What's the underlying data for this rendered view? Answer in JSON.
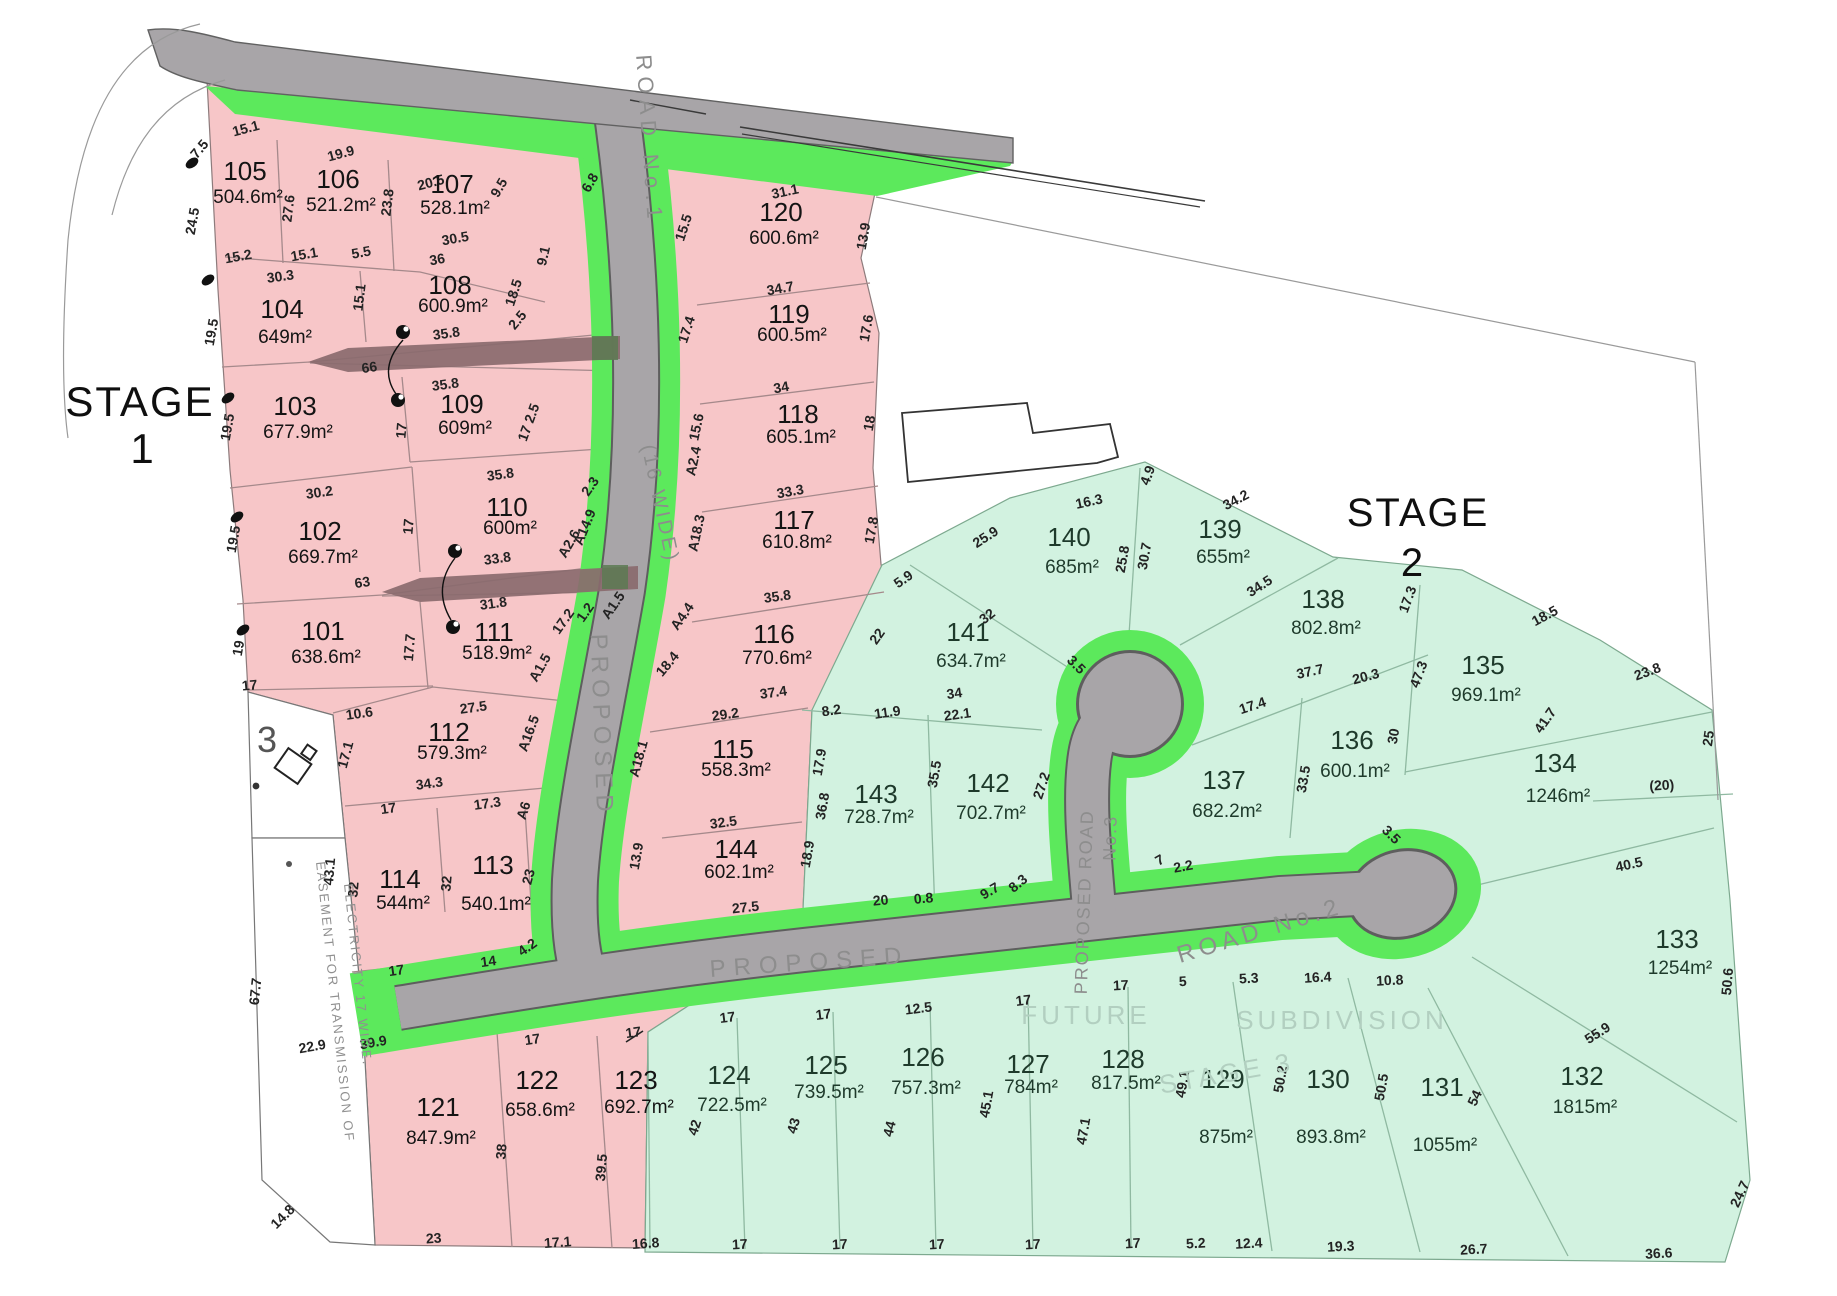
{
  "stage_labels": {
    "stage1_word": "STAGE",
    "stage1_num": "1",
    "stage2_word": "STAGE",
    "stage2_num": "2"
  },
  "road_labels": {
    "road1_name": "ROAD No.1",
    "road1_width": "(16 WIDE)",
    "road1_proposed": "PROPOSED",
    "road2_proposed": "PROPOSED",
    "road2_name": "ROAD No.2",
    "road3_line1": "PROPOSED ROAD",
    "road3_line2": "No.3"
  },
  "watermarks": {
    "future": "FUTURE",
    "subdivision": "SUBDIVISION",
    "stage3": "STAGE 3"
  },
  "easement": {
    "line1": "EASEMENT FOR TRANSMISSION OF",
    "line2": "ELECTRICITY 17 WIDE."
  },
  "existing_parcel": {
    "number": "3"
  },
  "colors": {
    "stage1_fill": "#f7c6c8",
    "stage2_fill": "#d2f2e0",
    "road_fill": "#a8a5a8",
    "road_casing": "#5e5e5e",
    "verge_green": "#5ce95c",
    "easement_arrow": "#8a6a6e",
    "arrow_overlap": "#5c7a52",
    "stage1_text": "#141414",
    "stage2_text": "#1e3a2b"
  },
  "lots": [
    [
      "101",
      "638.6m²",
      323,
      640,
      1,
      23
    ],
    [
      "102",
      "669.7m²",
      320,
      540,
      1,
      23
    ],
    [
      "103",
      "677.9m²",
      295,
      415,
      1,
      23
    ],
    [
      "104",
      "649m²",
      282,
      318,
      1,
      25
    ],
    [
      "105",
      "504.6m²",
      245,
      180,
      1,
      23
    ],
    [
      "106",
      "521.2m²",
      338,
      188,
      1,
      23
    ],
    [
      "107",
      "528.1m²",
      452,
      193,
      1,
      21
    ],
    [
      "108",
      "600.9m²",
      450,
      294,
      1,
      18
    ],
    [
      "109",
      "609m²",
      462,
      413,
      1,
      21
    ],
    [
      "110",
      "600m²",
      507,
      516,
      1,
      18
    ],
    [
      "111",
      "518.9m²",
      494,
      641,
      1,
      18
    ],
    [
      "112",
      "579.3m²",
      449,
      741,
      1,
      18
    ],
    [
      "113",
      "540.1m²",
      493,
      874,
      1,
      36
    ],
    [
      "114",
      "544m²",
      400,
      888,
      1,
      21
    ],
    [
      "115",
      "558.3m²",
      733,
      758,
      1,
      18
    ],
    [
      "116",
      "770.6m²",
      774,
      643,
      1,
      21
    ],
    [
      "117",
      "610.8m²",
      794,
      529,
      1,
      19
    ],
    [
      "118",
      "605.1m²",
      798,
      423,
      1,
      20
    ],
    [
      "119",
      "600.5m²",
      789,
      323,
      1,
      18
    ],
    [
      "120",
      "600.6m²",
      781,
      221,
      1,
      23
    ],
    [
      "121",
      "847.9m²",
      438,
      1116,
      1,
      28
    ],
    [
      "122",
      "658.6m²",
      537,
      1089,
      1,
      27
    ],
    [
      "123",
      "692.7m²",
      636,
      1089,
      1,
      24
    ],
    [
      "124",
      "722.5m²",
      729,
      1084,
      2,
      27
    ],
    [
      "125",
      "739.5m²",
      826,
      1074,
      2,
      24
    ],
    [
      "126",
      "757.3m²",
      923,
      1066,
      2,
      28
    ],
    [
      "127",
      "784m²",
      1028,
      1073,
      2,
      20
    ],
    [
      "128",
      "817.5m²",
      1123,
      1068,
      2,
      21
    ],
    [
      "129",
      "875m²",
      1223,
      1088,
      2,
      55
    ],
    [
      "130",
      "893.8m²",
      1328,
      1088,
      2,
      55
    ],
    [
      "131",
      "1055m²",
      1442,
      1096,
      2,
      55
    ],
    [
      "132",
      "1815m²",
      1582,
      1085,
      2,
      28
    ],
    [
      "133",
      "1254m²",
      1677,
      948,
      2,
      26
    ],
    [
      "134",
      "1246m²",
      1555,
      772,
      2,
      30
    ],
    [
      "135",
      "969.1m²",
      1483,
      674,
      2,
      27
    ],
    [
      "136",
      "600.1m²",
      1352,
      749,
      2,
      28
    ],
    [
      "137",
      "682.2m²",
      1224,
      789,
      2,
      28
    ],
    [
      "138",
      "802.8m²",
      1323,
      608,
      2,
      26
    ],
    [
      "139",
      "655m²",
      1220,
      538,
      2,
      25
    ],
    [
      "140",
      "685m²",
      1069,
      546,
      2,
      27
    ],
    [
      "141",
      "634.7m²",
      968,
      641,
      2,
      26
    ],
    [
      "142",
      "702.7m²",
      988,
      792,
      2,
      27
    ],
    [
      "143",
      "728.7m²",
      876,
      803,
      2,
      20
    ],
    [
      "144",
      "602.1m²",
      736,
      858,
      1,
      20
    ]
  ],
  "dims": [
    [
      "7.5",
      203,
      152,
      -50
    ],
    [
      "15.1",
      247,
      133,
      -15
    ],
    [
      "19.9",
      342,
      158,
      -15
    ],
    [
      "20.5",
      432,
      187,
      -15
    ],
    [
      "9.5",
      503,
      190,
      -60
    ],
    [
      "24.5",
      197,
      222,
      -80
    ],
    [
      "27.6",
      293,
      209,
      -83
    ],
    [
      "23.8",
      392,
      203,
      -83
    ],
    [
      "9.1",
      548,
      257,
      -77
    ],
    [
      "6.8",
      594,
      185,
      -60
    ],
    [
      "15.5",
      688,
      229,
      -72
    ],
    [
      "31.1",
      786,
      196,
      -12
    ],
    [
      "13.9",
      868,
      237,
      -80
    ],
    [
      "15.2",
      239,
      261,
      -10
    ],
    [
      "15.1",
      305,
      259,
      -10
    ],
    [
      "5.5",
      362,
      257,
      -10
    ],
    [
      "36",
      438,
      264,
      -10
    ],
    [
      "30.5",
      456,
      243,
      -10
    ],
    [
      "18.5",
      518,
      294,
      -72
    ],
    [
      "30.3",
      281,
      281,
      -8
    ],
    [
      "15.1",
      364,
      298,
      -83
    ],
    [
      "19.5",
      216,
      333,
      -80
    ],
    [
      "2.5",
      521,
      323,
      -50
    ],
    [
      "35.8",
      447,
      338,
      -8
    ],
    [
      "66",
      370,
      372,
      -8
    ],
    [
      "35.8",
      446,
      389,
      -8
    ],
    [
      "17.4",
      691,
      331,
      -72
    ],
    [
      "34.7",
      781,
      293,
      -10
    ],
    [
      "17.6",
      871,
      329,
      -80
    ],
    [
      "34",
      782,
      392,
      -10
    ],
    [
      "18",
      874,
      424,
      -80
    ],
    [
      "17 2.5",
      533,
      424,
      -70
    ],
    [
      "19.5",
      232,
      428,
      -80
    ],
    [
      "17",
      406,
      431,
      -85
    ],
    [
      "35.8",
      501,
      479,
      -8
    ],
    [
      "30.2",
      320,
      497,
      -8
    ],
    [
      "17",
      413,
      527,
      -85
    ],
    [
      "33.8",
      498,
      563,
      -8
    ],
    [
      "2.3",
      594,
      489,
      -55
    ],
    [
      "A14.9",
      589,
      529,
      -68
    ],
    [
      "A2.6",
      573,
      546,
      -60
    ],
    [
      "63",
      363,
      587,
      -8
    ],
    [
      "19.5",
      238,
      540,
      -80
    ],
    [
      "31.8",
      494,
      608,
      -8
    ],
    [
      "17.2",
      567,
      624,
      -55
    ],
    [
      "1.2",
      589,
      615,
      -55
    ],
    [
      "A1.5",
      617,
      608,
      -55
    ],
    [
      "A1.5",
      544,
      670,
      -60
    ],
    [
      "19",
      243,
      649,
      -80
    ],
    [
      "17.7",
      414,
      648,
      -85
    ],
    [
      "15.6",
      701,
      428,
      -78
    ],
    [
      "A2.4",
      698,
      462,
      -78
    ],
    [
      "33.3",
      791,
      496,
      -10
    ],
    [
      "17.8",
      876,
      531,
      -80
    ],
    [
      "A18.3",
      701,
      534,
      -78
    ],
    [
      "35.8",
      778,
      601,
      -8
    ],
    [
      "A4.4",
      686,
      619,
      -55
    ],
    [
      "18.4",
      671,
      667,
      -50
    ],
    [
      "5.9",
      906,
      583,
      -35
    ],
    [
      "22",
      881,
      639,
      -55
    ],
    [
      "37.4",
      774,
      697,
      -8
    ],
    [
      "29.2",
      726,
      719,
      -8
    ],
    [
      "A18.1",
      643,
      760,
      -75
    ],
    [
      "17",
      250,
      690,
      -5
    ],
    [
      "10.6",
      360,
      718,
      -8
    ],
    [
      "17.1",
      350,
      756,
      -75
    ],
    [
      "27.5",
      474,
      712,
      -8
    ],
    [
      "A16.5",
      533,
      735,
      -70
    ],
    [
      "34.3",
      430,
      788,
      -8
    ],
    [
      "17",
      389,
      813,
      -8
    ],
    [
      "17.3",
      488,
      808,
      -8
    ],
    [
      "A6",
      528,
      812,
      -72
    ],
    [
      "32",
      358,
      890,
      -85
    ],
    [
      "32",
      451,
      884,
      -85
    ],
    [
      "23",
      533,
      878,
      -75
    ],
    [
      "43.1",
      334,
      872,
      -85
    ],
    [
      "13.9",
      641,
      857,
      -80
    ],
    [
      "32.5",
      724,
      827,
      -8
    ],
    [
      "18.9",
      812,
      855,
      -80
    ],
    [
      "27.5",
      746,
      912,
      -6
    ],
    [
      "36.8",
      827,
      807,
      -80
    ],
    [
      "17.9",
      824,
      763,
      -80
    ],
    [
      "35.5",
      939,
      775,
      -80
    ],
    [
      "27.2",
      1046,
      787,
      -72
    ],
    [
      "20",
      881,
      905,
      -5
    ],
    [
      "0.8",
      924,
      903,
      -5
    ],
    [
      "9.7",
      992,
      895,
      -30
    ],
    [
      "8.3",
      1021,
      887,
      -40
    ],
    [
      "7",
      1162,
      864,
      -30
    ],
    [
      "2.2",
      1184,
      871,
      -10
    ],
    [
      "4.2",
      530,
      951,
      -35
    ],
    [
      "14",
      489,
      966,
      -8
    ],
    [
      "17",
      397,
      975,
      -8
    ],
    [
      "22.9",
      313,
      1051,
      -10
    ],
    [
      "39.9",
      374,
      1047,
      -10
    ],
    [
      "17",
      533,
      1044,
      -8
    ],
    [
      "17",
      634,
      1037,
      -8
    ],
    [
      "67.7",
      260,
      992,
      -84
    ],
    [
      "14.8",
      286,
      1220,
      -45
    ],
    [
      "38",
      506,
      1152,
      -85
    ],
    [
      "39.5",
      606,
      1168,
      -85
    ],
    [
      "23",
      434,
      1243,
      -4
    ],
    [
      "17.1",
      558,
      1247,
      -4
    ],
    [
      "16.8",
      646,
      1248,
      -4
    ],
    [
      "42",
      699,
      1129,
      -72
    ],
    [
      "43",
      798,
      1127,
      -74
    ],
    [
      "44",
      894,
      1130,
      -76
    ],
    [
      "45.1",
      991,
      1105,
      -80
    ],
    [
      "47.1",
      1088,
      1132,
      -80
    ],
    [
      "17",
      728,
      1022,
      -7
    ],
    [
      "17",
      824,
      1019,
      -7
    ],
    [
      "12.5",
      919,
      1013,
      -7
    ],
    [
      "17",
      1024,
      1005,
      -7
    ],
    [
      "17",
      740,
      1249,
      -3
    ],
    [
      "17",
      840,
      1249,
      -3
    ],
    [
      "17",
      937,
      1249,
      -3
    ],
    [
      "17",
      1033,
      1249,
      -3
    ],
    [
      "17",
      1133,
      1248,
      -3
    ],
    [
      "16.3",
      1090,
      506,
      -12
    ],
    [
      "25.9",
      988,
      541,
      -33
    ],
    [
      "4.9",
      1152,
      477,
      -70
    ],
    [
      "34.2",
      1238,
      504,
      -28
    ],
    [
      "25.8",
      1127,
      560,
      -80
    ],
    [
      "30.7",
      1149,
      557,
      -80
    ],
    [
      "34.5",
      1262,
      590,
      -33
    ],
    [
      "32",
      990,
      620,
      -38
    ],
    [
      "34",
      955,
      698,
      -8
    ],
    [
      "22.1",
      958,
      719,
      -8
    ],
    [
      "11.9",
      888,
      717,
      -8
    ],
    [
      "8.2",
      832,
      715,
      -8
    ],
    [
      "37.7",
      1311,
      676,
      -12
    ],
    [
      "20.3",
      1367,
      681,
      -15
    ],
    [
      "17.4",
      1254,
      710,
      -18
    ],
    [
      "33.5",
      1308,
      780,
      -80
    ],
    [
      "30",
      1398,
      737,
      -80
    ],
    [
      "47.3",
      1423,
      676,
      -70
    ],
    [
      "17.3",
      1412,
      601,
      -70
    ],
    [
      "18.5",
      1547,
      620,
      -28
    ],
    [
      "23.8",
      1649,
      676,
      -20
    ],
    [
      "25",
      1713,
      739,
      -82
    ],
    [
      "41.7",
      1549,
      723,
      -55
    ],
    [
      "(20)",
      1662,
      790,
      -3
    ],
    [
      "40.5",
      1630,
      869,
      -12
    ],
    [
      "50.6",
      1732,
      982,
      -85
    ],
    [
      "55.9",
      1600,
      1037,
      -33
    ],
    [
      "54",
      1479,
      1100,
      -65
    ],
    [
      "50.5",
      1386,
      1088,
      -80
    ],
    [
      "10.8",
      1390,
      985,
      -3
    ],
    [
      "16.4",
      1318,
      982,
      -3
    ],
    [
      "5.3",
      1249,
      983,
      -3
    ],
    [
      "5",
      1183,
      986,
      -3
    ],
    [
      "17",
      1121,
      990,
      -3
    ],
    [
      "50.2",
      1285,
      1080,
      -80
    ],
    [
      "49.1",
      1187,
      1085,
      -80
    ],
    [
      "24.7",
      1744,
      1196,
      -65
    ],
    [
      "36.6",
      1659,
      1258,
      -3
    ],
    [
      "26.7",
      1474,
      1254,
      -3
    ],
    [
      "19.3",
      1341,
      1251,
      -3
    ],
    [
      "12.4",
      1249,
      1248,
      -3
    ],
    [
      "5.2",
      1196,
      1248,
      -3
    ],
    [
      "3.5",
      1073,
      668,
      45
    ],
    [
      "3.5",
      1388,
      838,
      45
    ]
  ]
}
